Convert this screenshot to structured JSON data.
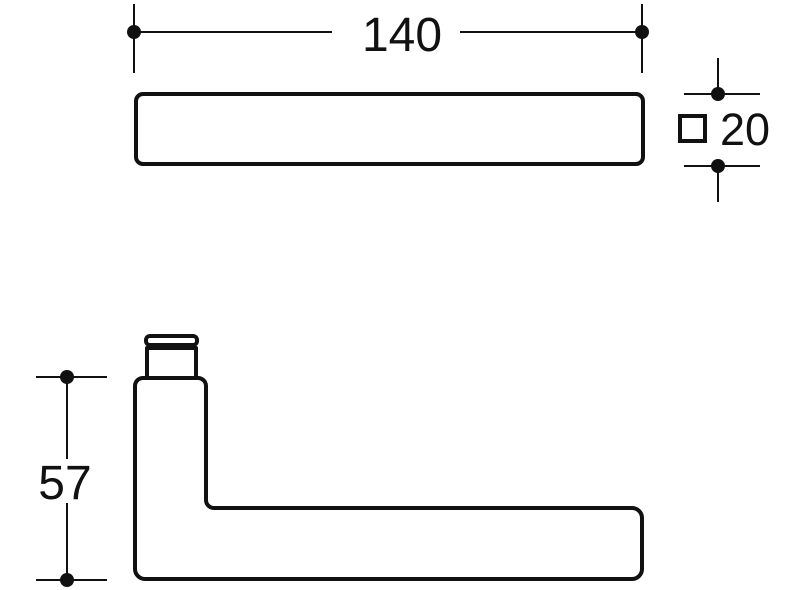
{
  "drawing": {
    "colors": {
      "line": "#111111",
      "background": "#ffffff"
    },
    "dimensions": {
      "length": {
        "value": "140"
      },
      "square_section": {
        "symbol": "□",
        "value": "20"
      },
      "height": {
        "value": "57"
      }
    }
  }
}
